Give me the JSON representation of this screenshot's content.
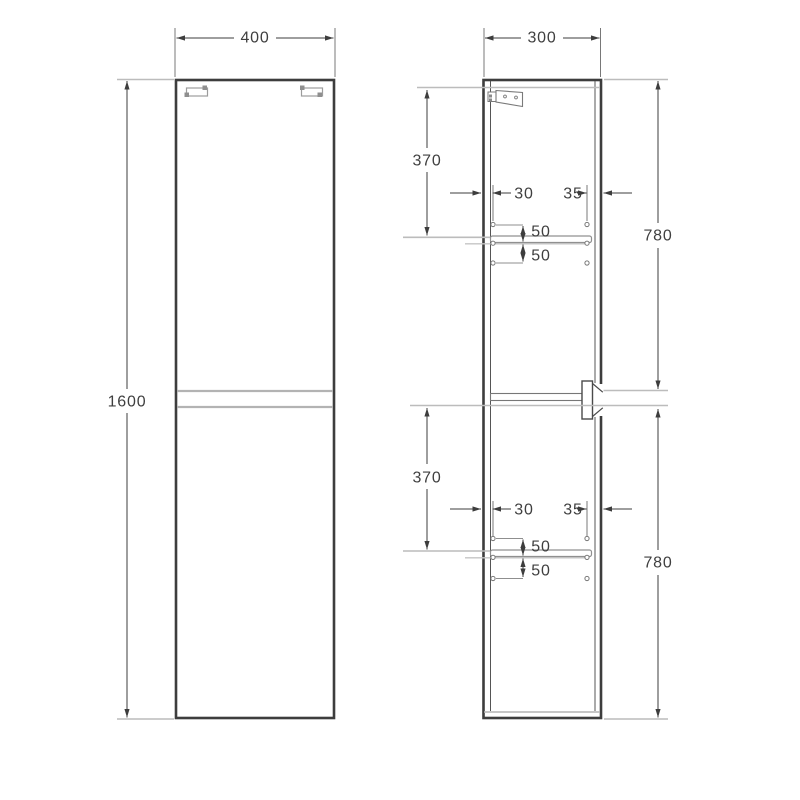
{
  "drawing_type": "cabinet technical drawing, front and side elevation",
  "colors": {
    "outline_dark": "#3d3d3d",
    "inner_line": "#555555",
    "construction_gray": "#bcbcbc",
    "door_gap_gray": "#b3b3b3",
    "detail_gray": "#8f8f8f",
    "background": "#ffffff"
  },
  "front_view": {
    "width_mm": "400",
    "height_mm": "1600"
  },
  "side_view": {
    "depth_mm": "300",
    "sections": [
      {
        "shelf_from_top_mm": "370",
        "door_height_mm": "780",
        "hole_back_offset_mm": "30",
        "hole_front_offset_mm": "35",
        "hole_pitch_above_mm": "50",
        "hole_pitch_below_mm": "50"
      },
      {
        "shelf_from_top_mm": "370",
        "door_height_mm": "780",
        "hole_back_offset_mm": "30",
        "hole_front_offset_mm": "35",
        "hole_pitch_above_mm": "50",
        "hole_pitch_below_mm": "50"
      }
    ]
  }
}
